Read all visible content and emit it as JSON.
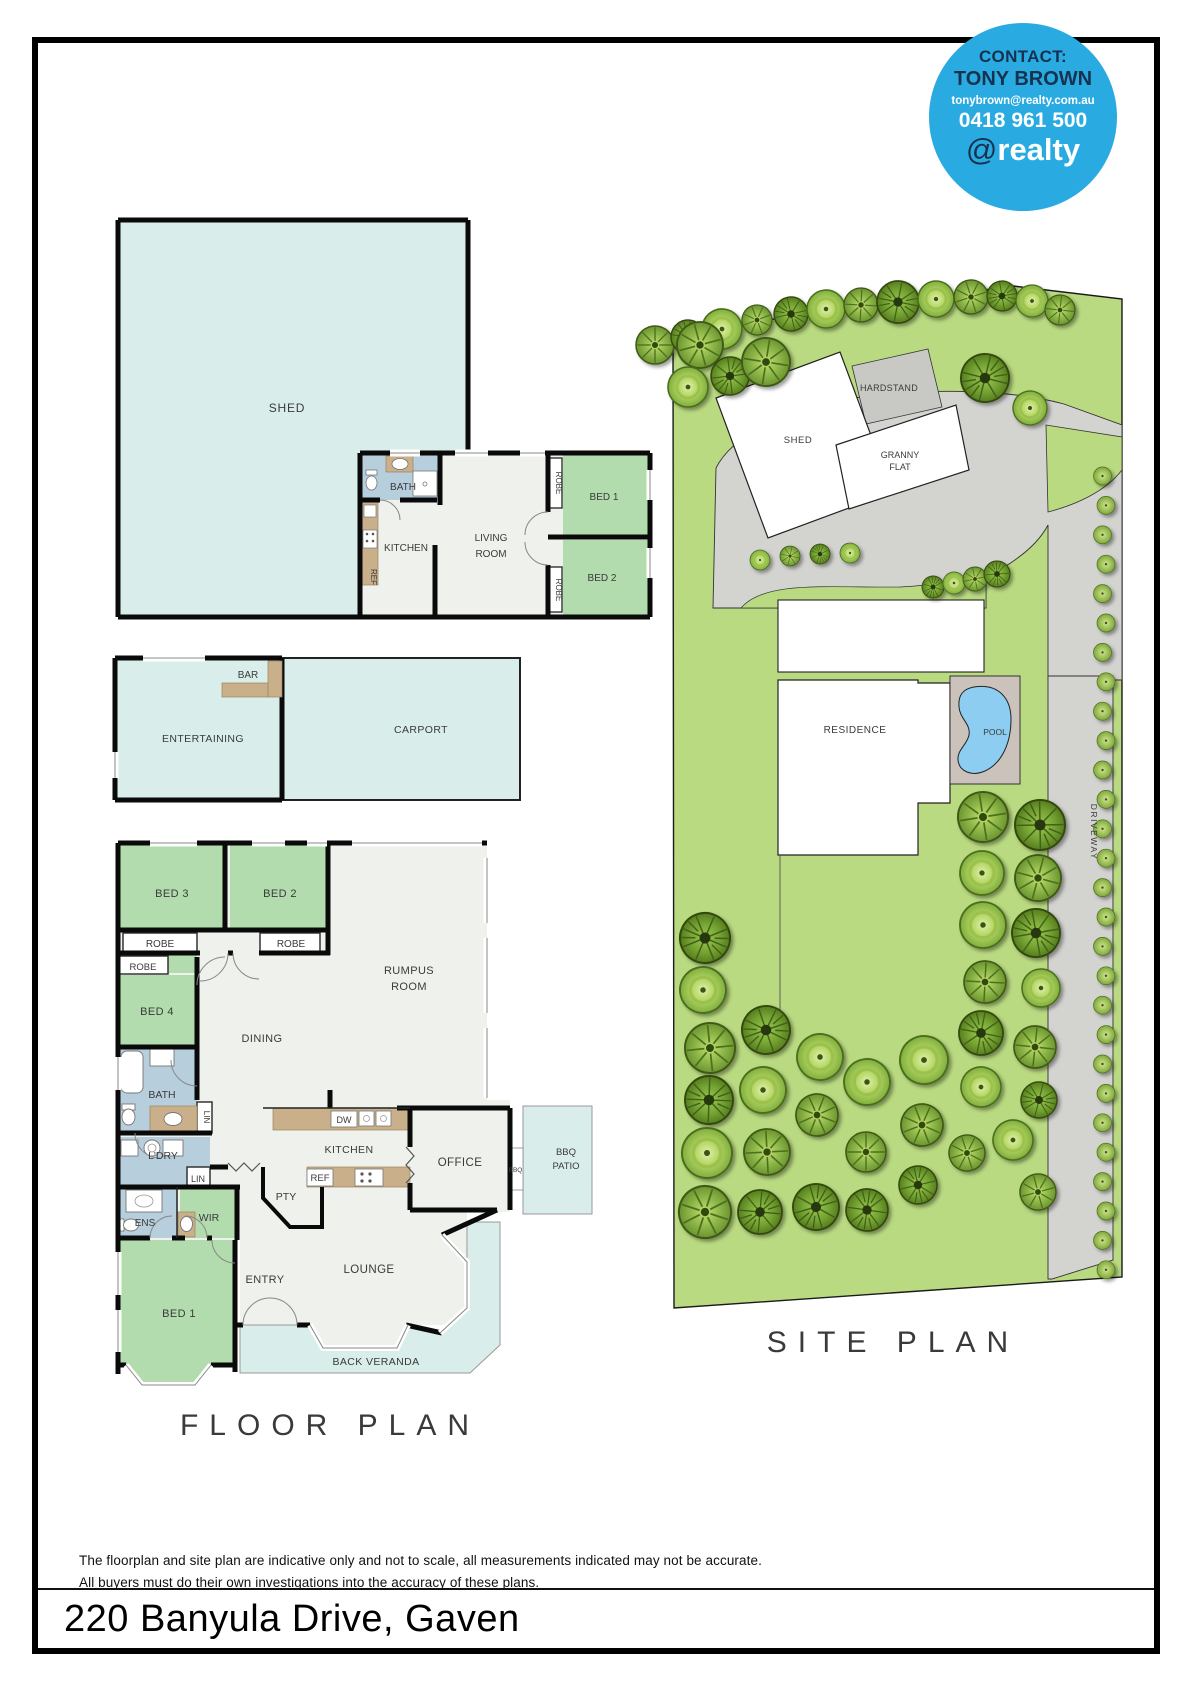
{
  "page": {
    "address": "220 Banyula Drive, Gaven",
    "disclaimer_line1": "The floorplan and site plan are indicative only and not to scale, all measurements indicated may not be accurate.",
    "disclaimer_line2": "All buyers must do their own investigations into the accuracy of these plans.",
    "floor_plan_title": "FLOOR PLAN",
    "site_plan_title": "SITE PLAN"
  },
  "contact": {
    "heading": "CONTACT:",
    "name": "TONY BROWN",
    "email": "tonybrown@realty.com.au",
    "phone": "0418 961 500",
    "brand_at": "@",
    "brand_name": "realty",
    "circle_color": "#29abe2"
  },
  "colors": {
    "teal_area": "#d9eeea",
    "bedroom_green": "#b2dcae",
    "bath_blue": "#b7cedd",
    "floor": "#eff1ec",
    "counter_tan": "#c9b08a",
    "wall": "#0a0a0a",
    "grass": "#b9da81",
    "driveway": "#d3d3d0",
    "hardstand": "#c8c8c5",
    "pool_water": "#8ccdf1",
    "pool_deck": "#cbc3bb",
    "accent_blue": "#29abe2"
  },
  "granny_flat_plan": {
    "shed": "SHED",
    "bath": "BATH",
    "kitchen": "KITCHEN",
    "ref": "REF",
    "living1": "LIVING",
    "living2": "ROOM",
    "robe_top": "ROBE",
    "bed1": "BED 1",
    "robe_bottom": "ROBE",
    "bed2": "BED 2"
  },
  "outbuilding_plan": {
    "bar": "BAR",
    "entertaining": "ENTERTAINING",
    "carport": "CARPORT"
  },
  "main_floor_plan": {
    "bed3": "BED 3",
    "bed2": "BED 2",
    "robe_bed3": "ROBE",
    "robe_bed2": "ROBE",
    "robe_bed4": "ROBE",
    "bed4": "BED 4",
    "dining": "DINING",
    "rumpus1": "RUMPUS",
    "rumpus2": "ROOM",
    "bath": "BATH",
    "lin1": "LIN",
    "ldry": "L'DRY",
    "lin2": "LIN",
    "ens": "ENS",
    "wir": "WIR",
    "pty": "PTY",
    "kitchen": "KITCHEN",
    "dw": "DW",
    "ref": "REF",
    "office": "OFFICE",
    "bbq": "BBQ",
    "bbq_patio1": "BBQ",
    "bbq_patio2": "PATIO",
    "entry": "ENTRY",
    "lounge": "LOUNGE",
    "bed1": "BED 1",
    "back_veranda": "BACK VERANDA"
  },
  "site_plan": {
    "shed": "SHED",
    "hardstand": "HARDSTAND",
    "granny1": "GRANNY",
    "granny2": "FLAT",
    "residence": "RESIDENCE",
    "pool": "POOL",
    "driveway": "DRIVEWAY",
    "trees_top": [
      [
        655,
        345,
        19
      ],
      [
        688,
        337,
        17
      ],
      [
        722,
        329,
        20
      ],
      [
        757,
        320,
        15
      ],
      [
        791,
        314,
        17
      ],
      [
        826,
        309,
        19
      ],
      [
        861,
        305,
        17
      ],
      [
        898,
        302,
        21
      ],
      [
        936,
        299,
        18
      ],
      [
        971,
        297,
        17
      ],
      [
        1002,
        296,
        15
      ],
      [
        1032,
        301,
        16
      ],
      [
        1060,
        310,
        15
      ],
      [
        985,
        378,
        24
      ],
      [
        1030,
        408,
        17
      ],
      [
        700,
        345,
        23
      ],
      [
        730,
        376,
        19
      ],
      [
        688,
        387,
        20
      ],
      [
        766,
        362,
        24
      ]
    ],
    "trees_small": [
      [
        933,
        587,
        11
      ],
      [
        954,
        583,
        11
      ],
      [
        975,
        579,
        12
      ],
      [
        997,
        574,
        13
      ],
      [
        760,
        560,
        10
      ],
      [
        790,
        556,
        10
      ],
      [
        820,
        554,
        10
      ],
      [
        850,
        553,
        10
      ]
    ],
    "trees_back": [
      [
        983,
        817,
        25
      ],
      [
        1040,
        825,
        25
      ],
      [
        982,
        873,
        22
      ],
      [
        1038,
        878,
        23
      ],
      [
        705,
        938,
        25
      ],
      [
        703,
        990,
        23
      ],
      [
        710,
        1048,
        25
      ],
      [
        709,
        1100,
        24
      ],
      [
        707,
        1153,
        25
      ],
      [
        705,
        1212,
        26
      ],
      [
        766,
        1030,
        24
      ],
      [
        763,
        1090,
        23
      ],
      [
        767,
        1152,
        23
      ],
      [
        760,
        1212,
        22
      ],
      [
        820,
        1057,
        23
      ],
      [
        817,
        1115,
        21
      ],
      [
        816,
        1207,
        23
      ],
      [
        867,
        1082,
        23
      ],
      [
        866,
        1152,
        20
      ],
      [
        867,
        1210,
        21
      ],
      [
        924,
        1060,
        24
      ],
      [
        922,
        1125,
        21
      ],
      [
        918,
        1185,
        19
      ],
      [
        983,
        925,
        23
      ],
      [
        985,
        982,
        21
      ],
      [
        981,
        1033,
        22
      ],
      [
        981,
        1087,
        20
      ],
      [
        967,
        1153,
        18
      ],
      [
        1036,
        933,
        24
      ],
      [
        1041,
        988,
        19
      ],
      [
        1035,
        1047,
        21
      ],
      [
        1039,
        1100,
        18
      ],
      [
        1013,
        1140,
        20
      ],
      [
        1038,
        1192,
        18
      ]
    ],
    "bush_row": {
      "x": 1104,
      "y_start": 476,
      "step": 29.4,
      "count": 28,
      "r": 9
    }
  }
}
